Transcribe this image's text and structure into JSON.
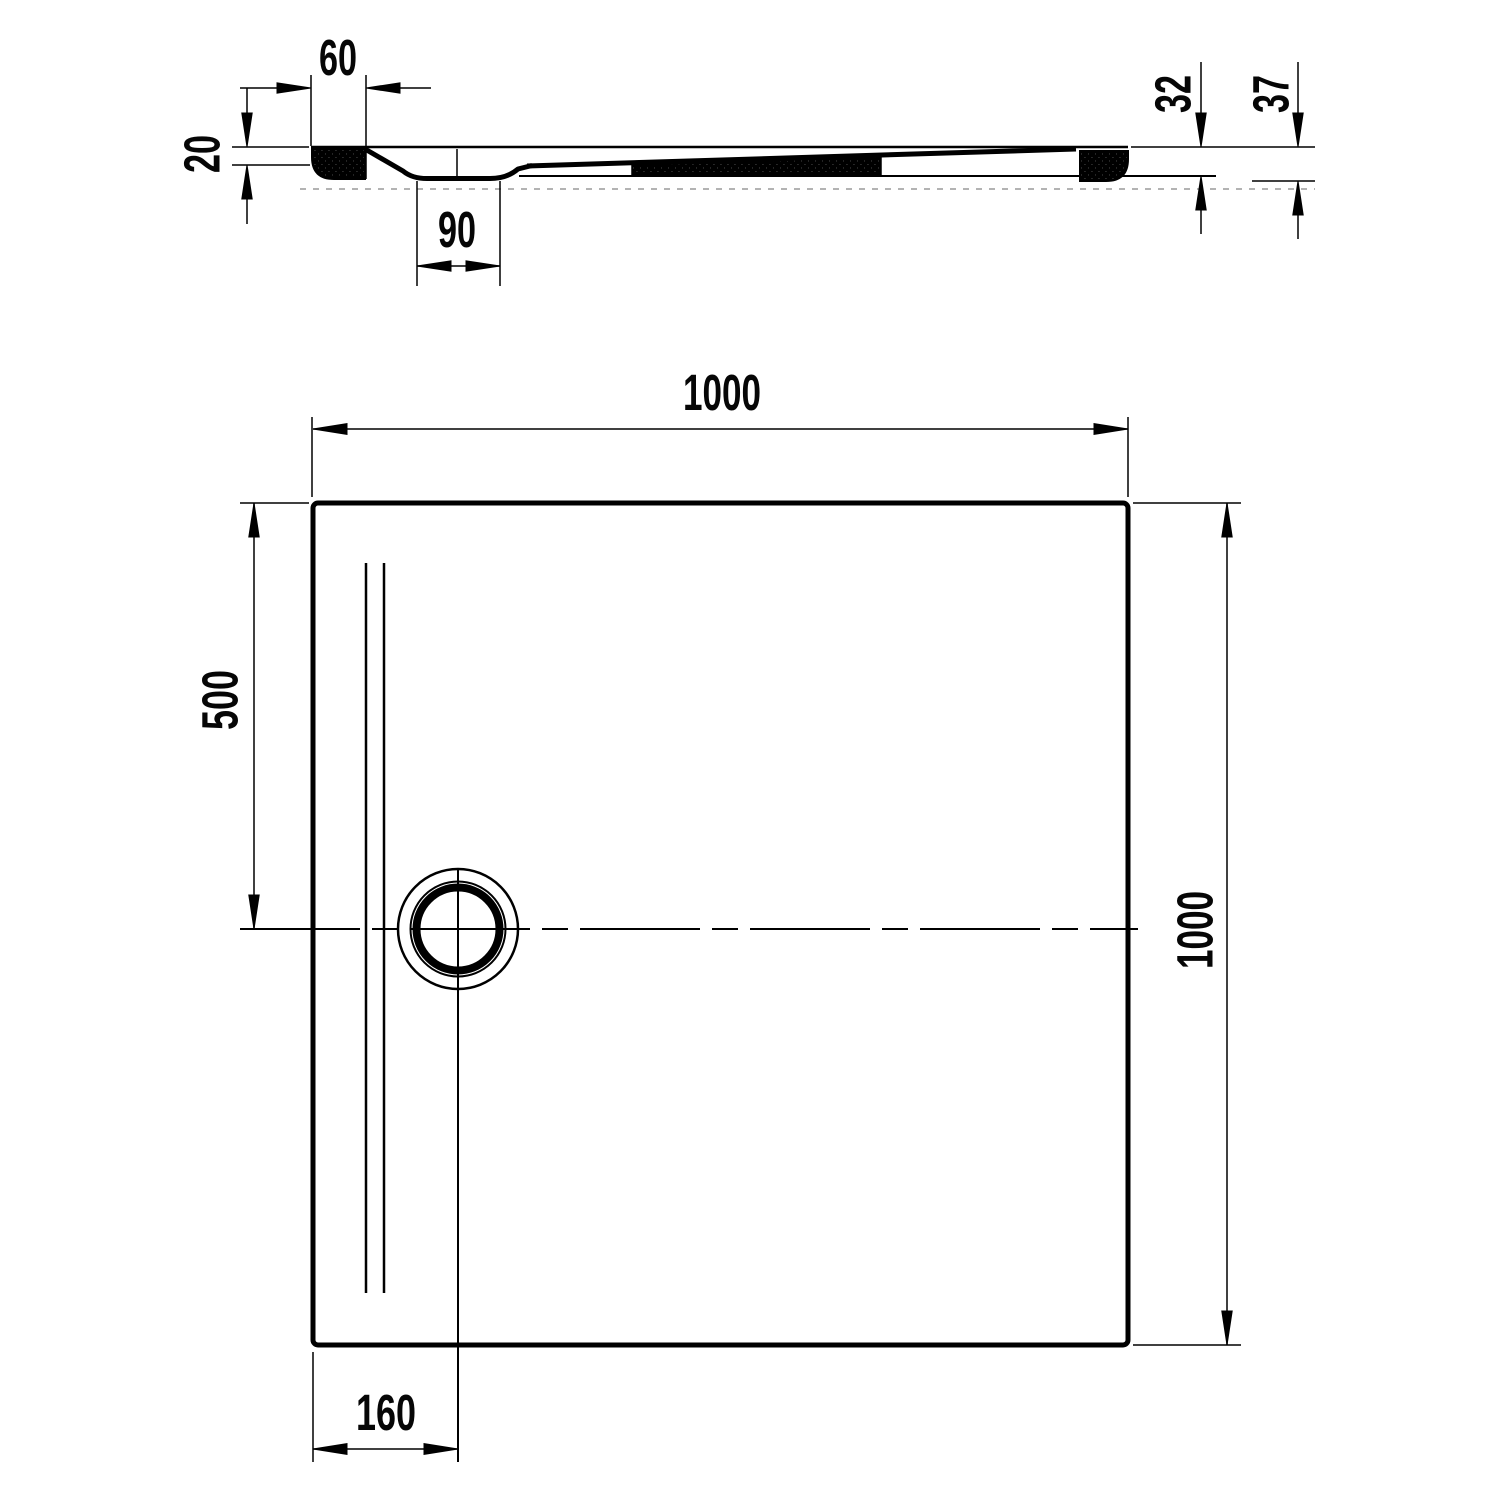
{
  "colors": {
    "line": "#000000",
    "background": "#ffffff",
    "faint_line": "#9a9a9a"
  },
  "section_view": {
    "dims": {
      "rim_width": "60",
      "edge_thickness": "20",
      "drain_recess_width": "90",
      "height_rim": "32",
      "height_total": "37"
    }
  },
  "plan_view": {
    "dims": {
      "width": "1000",
      "depth": "1000",
      "drain_offset_top": "500",
      "drain_offset_left": "160"
    }
  }
}
